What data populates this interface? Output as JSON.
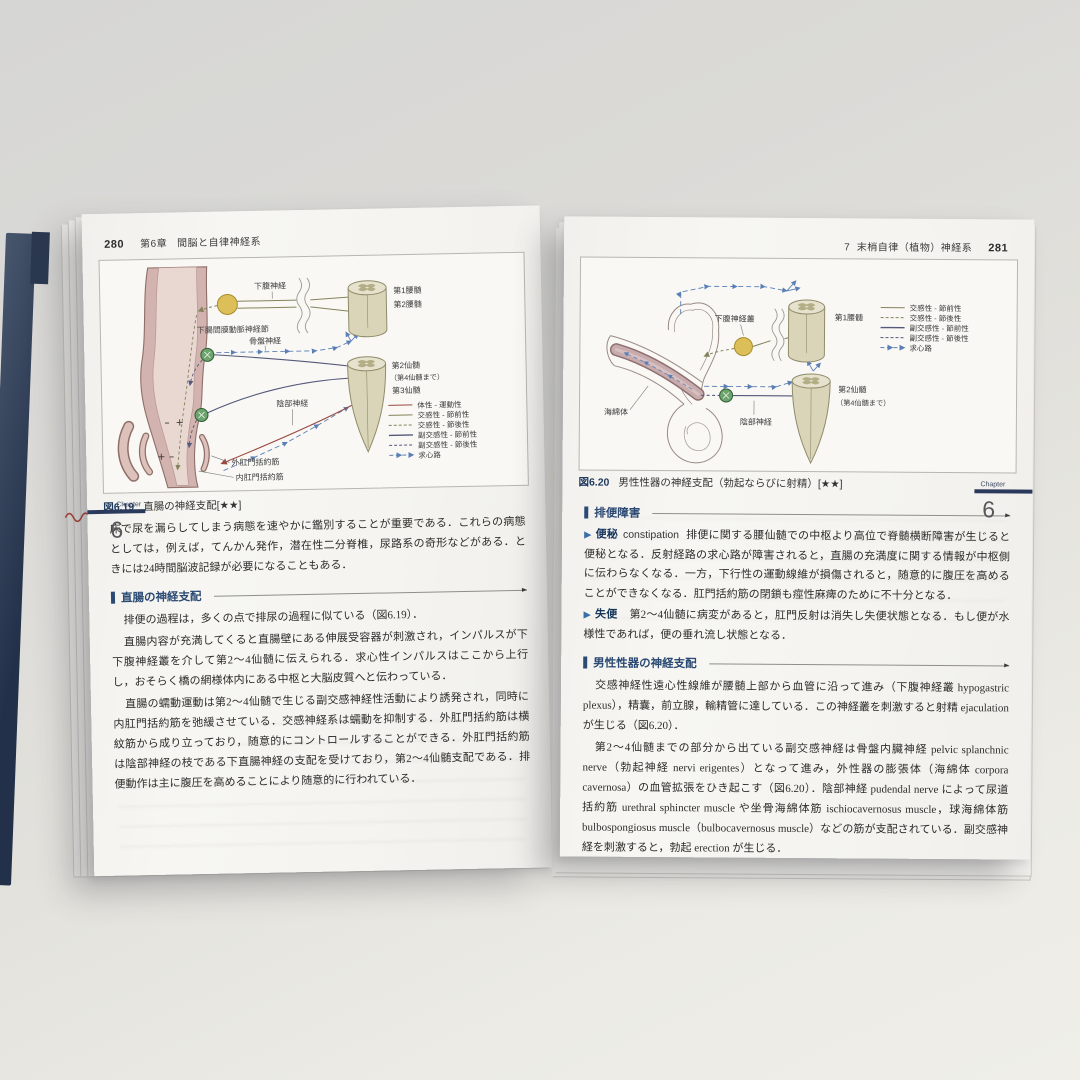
{
  "palette": {
    "somatic": "#9a4a42",
    "sympathetic": "#83835c",
    "parasympathetic": "#54587a",
    "afferent": "#5b7fb5",
    "heading_blue": "#2b4a73",
    "tab_bar_navy": "#2b3a5c",
    "organ_pink": "#d2b3af",
    "cord_beige": "#dad5b8",
    "ganglion_yellow": "#dcbf58",
    "ganglion_green": "#6da46d"
  },
  "left_page": {
    "header": {
      "page_num": "280",
      "chapter": "第6章",
      "title": "間脳と自律神経系"
    },
    "figure": {
      "caption_label": "図6.19",
      "caption_text": "直腸の神経支配[★★]",
      "labels": {
        "hypogastric_nerve": "下腹神経",
        "l1": "第1腰髄",
        "l2": "第2腰髄",
        "inferior_mesenteric_ganglion": "下腸間膜動脈神経節",
        "pelvic_nerve": "骨盤神経",
        "s2": "第2仙髄",
        "s2_note": "（第4仙髄まで）",
        "s3": "第3仙髄",
        "pudendal_nerve": "陰部神経",
        "external_anal_sphincter": "外肛門括約筋",
        "internal_anal_sphincter": "内肛門括約筋",
        "minus": "−",
        "plus": "＋"
      },
      "legend": {
        "somatic_motor": "体性 - 運動性",
        "sympathetic_pre": "交感性 - 節前性",
        "sympathetic_post": "交感性 - 節後性",
        "parasympathetic_pre": "副交感性 - 節前性",
        "parasympathetic_post": "副交感性 - 節後性",
        "afferent": "求心路"
      }
    },
    "intro_paragraph": "床で尿を漏らしてしまう病態を速やかに鑑別することが重要である．これらの病態としては，例えば，てんかん発作，潜在性二分脊椎，尿路系の奇形などがある．ときには24時間脳波記録が必要になることもある．",
    "section": {
      "title": "直腸の神経支配",
      "p1": "排便の過程は，多くの点で排尿の過程に似ている（図6.19）．",
      "p2": "直腸内容が充満してくると直腸壁にある伸展受容器が刺激され，インパルスが下下腹神経叢を介して第2～4仙髄に伝えられる．求心性インパルスはここから上行し，おそらく橋の網様体内にある中枢と大脳皮質へと伝わっている．",
      "p3": "直腸の蠕動運動は第2～4仙髄で生じる副交感神経性活動により誘発され，同時に内肛門括約筋を弛緩させている．交感神経系は蠕動を抑制する．外肛門括約筋は横紋筋から成り立っており，随意的にコントロールすることができる．外肛門括約筋は陰部神経の枝である下直腸神経の支配を受けており，第2～4仙髄支配である．排便動作は主に腹圧を高めることにより随意的に行われている．"
    },
    "chapter_tab": {
      "label": "Chapter",
      "number": "6"
    }
  },
  "right_page": {
    "header": {
      "section_num": "7",
      "title": "末梢自律（植物）神経系",
      "page_num": "281"
    },
    "figure": {
      "caption_label": "図6.20",
      "caption_text": "男性性器の神経支配（勃起ならびに射精）[★★]",
      "labels": {
        "hypogastric_plexus": "下腹神経叢",
        "l1": "第1腰髄",
        "corpus_cavernosum": "海綿体",
        "pudendal_nerve": "陰部神経",
        "s2": "第2仙髄",
        "s2_note": "（第4仙髄まで）"
      },
      "legend": {
        "sympathetic_pre": "交感性 - 節前性",
        "sympathetic_post": "交感性 - 節後性",
        "parasympathetic_pre": "副交感性 - 節前性",
        "parasympathetic_post": "副交感性 - 節後性",
        "afferent": "求心路"
      }
    },
    "defecation_section": {
      "title": "排便障害",
      "items": [
        {
          "marker": "▶",
          "term": "便秘",
          "term_en": "constipation",
          "text": "排便に関する腰仙髄での中枢より高位で脊髄横断障害が生じると便秘となる．反射経路の求心路が障害されると，直腸の充満度に関する情報が中枢側に伝わらなくなる．一方，下行性の運動線維が損傷されると，随意的に腹圧を高めることができなくなる．肛門括約筋の閉鎖も痙性麻痺のために不十分となる．"
        },
        {
          "marker": "▶",
          "term": "失便",
          "term_en": "",
          "text": "第2～4仙髄に病変があると，肛門反射は消失し失便状態となる．もし便が水様性であれば，便の垂れ流し状態となる．"
        }
      ]
    },
    "genital_section": {
      "title": "男性性器の神経支配",
      "p1": "交感神経性遠心性線維が腰髄上部から血管に沿って進み（下腹神経叢 hypogastric plexus），精囊，前立腺，輸精管に達している．この神経叢を刺激すると射精 ejaculation が生じる（図6.20）．",
      "p2": "第2～4仙髄までの部分から出ている副交感神経は骨盤内臓神経 pelvic splanchnic nerve（勃起神経 nervi erigentes）となって進み，外性器の膨張体（海綿体 corpora cavernosa）の血管拡張をひき起こす（図6.20）．陰部神経 pudendal nerve によって尿道括約筋 urethral sphincter muscle や坐骨海綿体筋 ischiocavernosus muscle，球海綿体筋 bulbospongiosus muscle（bulbocavernosus muscle）などの筋が支配されている．副交感神経を刺激すると，勃起 erection が生じる．"
    },
    "chapter_tab": {
      "label": "Chapter",
      "number": "6"
    }
  }
}
